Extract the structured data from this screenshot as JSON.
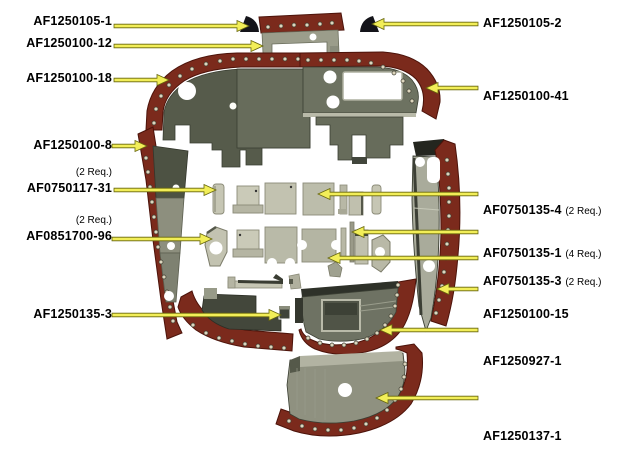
{
  "figure": {
    "kind": "exploded-parts-diagram"
  },
  "colors": {
    "background": "#ffffff",
    "flange_maroon": "#7b2a1c",
    "flange_edge": "#4c130a",
    "panel_olive_dark": "#4d5243",
    "panel_olive": "#6e7263",
    "panel_olive_light": "#8f9180",
    "plate_light": "#c2c2b0",
    "black_part": "#14141a",
    "rivet": "#ddd6be",
    "arrow_yellow": "#f2ee58",
    "arrow_outline": "#67660d",
    "label_text": "#000000"
  },
  "callouts_left": [
    {
      "part_number": "AF1250105-1",
      "req_note": "",
      "target": "black-wedge-left"
    },
    {
      "part_number": "AF1250100-12",
      "req_note": "",
      "target": "top-center-panel"
    },
    {
      "part_number": "AF1250100-18",
      "req_note": "",
      "target": "left-main-panel"
    },
    {
      "part_number": "AF1250100-8",
      "req_note": "",
      "target": "left-side-strip"
    },
    {
      "part_number": "AF0750117-31",
      "req_note": "(2 Req.)",
      "target": "small-clip-left"
    },
    {
      "part_number": "AF0851700-96",
      "req_note": "(2 Req.)",
      "target": "hex-plate-left"
    },
    {
      "part_number": "AF1250135-3",
      "req_note": "",
      "target": "small-square-clip"
    }
  ],
  "callouts_right": [
    {
      "part_number": "AF1250105-2",
      "req_note": "",
      "target": "black-wedge-right"
    },
    {
      "part_number": "AF1250100-41",
      "req_note": "",
      "target": "right-main-panel"
    },
    {
      "part_number": "AF0750135-4",
      "req_note": "(2 Req.)",
      "target": "square-plate"
    },
    {
      "part_number": "AF0750135-1",
      "req_note": "(4 Req.)",
      "target": "thin-strip"
    },
    {
      "part_number": "AF0750135-3",
      "req_note": "(2 Req.)",
      "target": "notched-plate"
    },
    {
      "part_number": "AF1250100-15",
      "req_note": "",
      "target": "right-side-strip"
    },
    {
      "part_number": "AF1250927-1",
      "req_note": "",
      "target": "bottom-center-panel"
    },
    {
      "part_number": "AF1250137-1",
      "req_note": "",
      "target": "bottom-panel"
    }
  ],
  "parts": [
    {
      "name": "black-wedge-left"
    },
    {
      "name": "black-wedge-right"
    },
    {
      "name": "top-center-panel"
    },
    {
      "name": "left-main-panel"
    },
    {
      "name": "right-main-panel"
    },
    {
      "name": "left-side-strip"
    },
    {
      "name": "right-side-strip"
    },
    {
      "name": "small-clip-left"
    },
    {
      "name": "hat-bracket"
    },
    {
      "name": "square-plate"
    },
    {
      "name": "thin-strip"
    },
    {
      "name": "hex-plate-left"
    },
    {
      "name": "notched-plate"
    },
    {
      "name": "hex-plate-right"
    },
    {
      "name": "channel-bracket"
    },
    {
      "name": "small-square-clip"
    },
    {
      "name": "bottom-left-panel"
    },
    {
      "name": "bottom-center-panel"
    },
    {
      "name": "bottom-panel"
    }
  ]
}
